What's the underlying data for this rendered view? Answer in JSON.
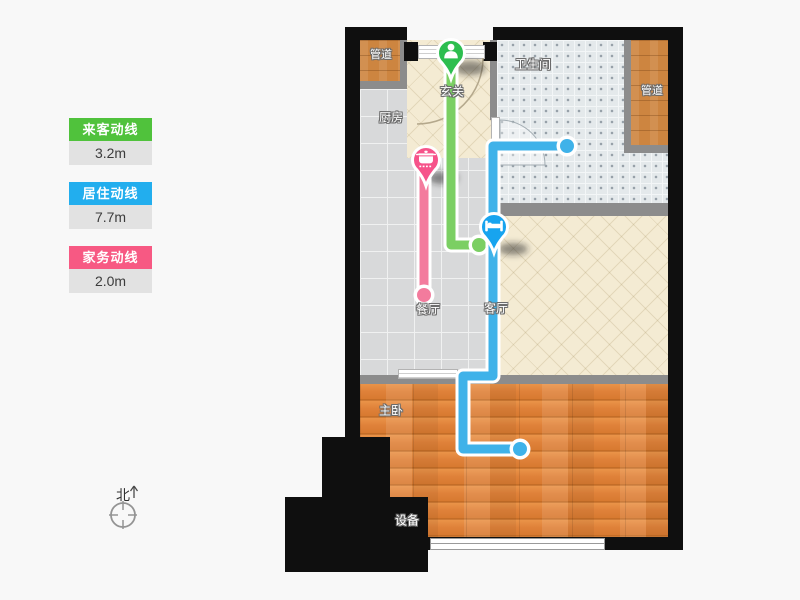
{
  "legend": {
    "items": [
      {
        "id": "guest",
        "label": "来客动线",
        "value": "3.2m",
        "color": "#50c23c"
      },
      {
        "id": "living",
        "label": "居住动线",
        "value": "7.7m",
        "color": "#22aeee"
      },
      {
        "id": "chore",
        "label": "家务动线",
        "value": "2.0m",
        "color": "#f75983"
      }
    ]
  },
  "compass": {
    "label": "北"
  },
  "floorplan": {
    "rooms": {
      "duct_top_left": {
        "label": "管道"
      },
      "entrance": {
        "label": "玄关"
      },
      "kitchen": {
        "label": "厨房"
      },
      "bathroom": {
        "label": "卫生间"
      },
      "duct_right": {
        "label": "管道"
      },
      "dining": {
        "label": "餐厅"
      },
      "living": {
        "label": "客厅"
      },
      "bedroom": {
        "label": "主卧"
      },
      "equipment": {
        "label": "设备"
      }
    },
    "routes": [
      {
        "id": "guest",
        "name": "来客动线",
        "length": "3.2m",
        "line_color": "#7bcf63",
        "pin_color": "#2dbe4f",
        "icon": "person-icon"
      },
      {
        "id": "living",
        "name": "居住动线",
        "length": "7.7m",
        "line_color": "#3fb2e9",
        "pin_color": "#17a4ef",
        "icon": "bed-icon"
      },
      {
        "id": "chore",
        "name": "家务动线",
        "length": "2.0m",
        "line_color": "#f37b9d",
        "pin_color": "#f6538a",
        "icon": "pot-icon"
      }
    ],
    "colors": {
      "outer_wall": "#0f0f0f",
      "inner_wall": "#8c8c8c",
      "background": "#f8f8f8"
    }
  }
}
